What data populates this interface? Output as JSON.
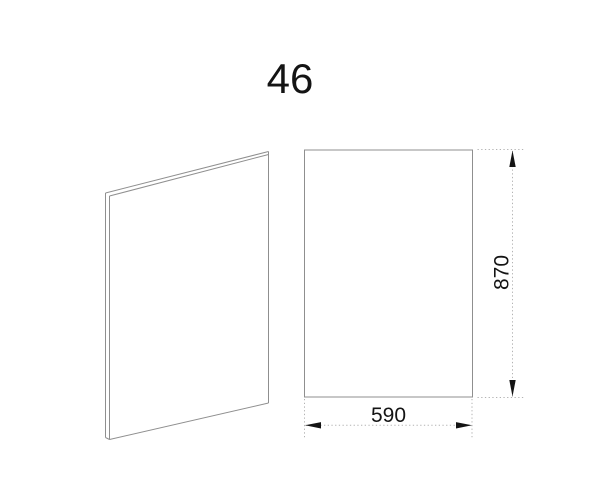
{
  "title": {
    "text": "46"
  },
  "drawing": {
    "type": "technical-drawing",
    "part": "panel",
    "views": {
      "isometric": {
        "name": "panel-isometric-view"
      },
      "front": {
        "name": "panel-front-view"
      }
    },
    "dimensions": {
      "width": {
        "value": "590"
      },
      "height": {
        "value": "870"
      }
    }
  },
  "colors": {
    "outline": "#8f8f8f",
    "dimline": "#b3b3b3",
    "ink": "#141414",
    "bg": "#ffffff"
  }
}
